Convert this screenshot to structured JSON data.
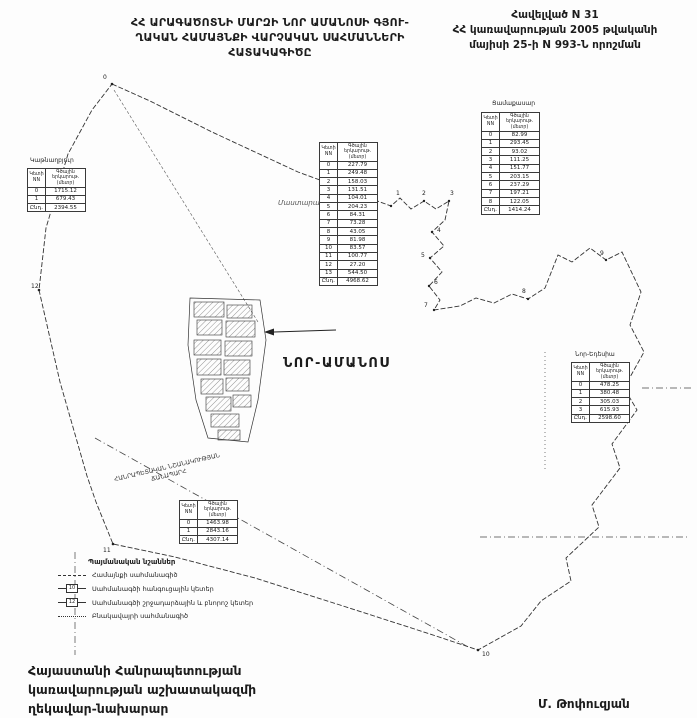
{
  "header": {
    "title_lines": [
      "ՀՀ ԱՐԱԳԱԾՈՏՆԻ ՄԱՐԶԻ ՆՈՐ ԱՄԱՆՈՍԻ ԳՅՈՒ-",
      "ՂԱԿԱՆ ՀԱՄԱՅՆՔԻ ՎԱՐՉԱԿԱՆ ՍԱՀՄԱՆՆԵՐԻ",
      "ՀԱՏԱԿԱԳԻԾԸ"
    ],
    "annex_lines": [
      "Հավելված N 31",
      "ՀՀ կառավարության 2005 թվականի",
      "մայիսի 25-ի N 993-Ն որոշման"
    ]
  },
  "map": {
    "center_label": "ՆՈՐ-ԱՄԱՆՈՍ",
    "neighbor_label": "Մաստարա",
    "road_label_lines": [
      "ՀԱՆՐԱՊԵՏԱԿԱՆ ՆՇԱՆԱԿՈՒԹՅԱՆ",
      "ՃԱՆԱՊԱՐՀ"
    ],
    "point_labels": [
      "0",
      "1",
      "2",
      "3",
      "4",
      "5",
      "6",
      "7",
      "8",
      "9",
      "10",
      "11",
      "12"
    ]
  },
  "tables": {
    "left": {
      "title": "Կաթնաղբյուր",
      "header": [
        "Կետի NN",
        "Գծային երկարութ. (մետր)"
      ],
      "rows": [
        [
          "0",
          "1715.12"
        ],
        [
          "1",
          "679.43"
        ],
        [
          "Ընդ.",
          "2394.55"
        ]
      ]
    },
    "center": {
      "title": "",
      "header": [
        "Կետի NN",
        "Գծային երկարութ. (մետր)"
      ],
      "rows": [
        [
          "0",
          "227.79"
        ],
        [
          "1",
          "249.48"
        ],
        [
          "2",
          "158.03"
        ],
        [
          "3",
          "131.51"
        ],
        [
          "4",
          "104.01"
        ],
        [
          "5",
          "204.23"
        ],
        [
          "6",
          "84.31"
        ],
        [
          "7",
          "73.28"
        ],
        [
          "8",
          "43.05"
        ],
        [
          "9",
          "81.98"
        ],
        [
          "10",
          "83.57"
        ],
        [
          "11",
          "100.77"
        ],
        [
          "12",
          "27.20"
        ],
        [
          "13",
          "544.50"
        ],
        [
          "Ընդ.",
          "4968.62"
        ]
      ]
    },
    "topright": {
      "title": "Ցամաքասար",
      "header": [
        "Կետի NN",
        "Գծային երկարութ. (մետր)"
      ],
      "rows": [
        [
          "0",
          "82.99"
        ],
        [
          "1",
          "293.45"
        ],
        [
          "2",
          "93.02"
        ],
        [
          "3",
          "111.25"
        ],
        [
          "4",
          "151.77"
        ],
        [
          "5",
          "203.15"
        ],
        [
          "6",
          "237.29"
        ],
        [
          "7",
          "197.21"
        ],
        [
          "8",
          "122.05"
        ],
        [
          "Ընդ.",
          "1414.24"
        ]
      ]
    },
    "right": {
      "title": "Նոր-Եդեսիա",
      "header": [
        "Կետի NN",
        "Գծային երկարութ. (մետր)"
      ],
      "rows": [
        [
          "0",
          "478.25"
        ],
        [
          "1",
          "380.48"
        ],
        [
          "2",
          "305.03"
        ],
        [
          "3",
          "615.93"
        ],
        [
          "Ընդ.",
          "2598.60"
        ]
      ]
    },
    "bottom": {
      "title": "",
      "header": [
        "Կետի NN",
        "Գծային երկարութ. (մետր)"
      ],
      "rows": [
        [
          "0",
          "1463.98"
        ],
        [
          "1",
          "2843.16"
        ],
        [
          "Ընդ.",
          "4307.14"
        ]
      ]
    }
  },
  "legend": {
    "title": "Պայմանական նշաններ",
    "items": [
      {
        "symbol": "community-boundary-line",
        "symbol_text": "",
        "label": "Համայնքի սահմանագիծ"
      },
      {
        "symbol": "node-point-box",
        "symbol_text": "10",
        "label": "Սահմանագծի հանգուցային կետեր"
      },
      {
        "symbol": "turn-point-box",
        "symbol_text": "12",
        "label": "Սահմանագծի շրջադարձային և բնորոշ կետեր"
      },
      {
        "symbol": "settlement-boundary-line",
        "symbol_text": "",
        "label": "Բնակավայրի սահմանագիծ"
      }
    ]
  },
  "footer": {
    "signature_lines": [
      "Հայաստանի Հանրապետության",
      "կառավարության աշխատակազմի",
      "ղեկավար-նախարար"
    ],
    "signer": "Մ. Թոփուզյան"
  },
  "colors": {
    "ink": "#1c1c1c",
    "line": "#3a3a3a",
    "paper": "#fdfdfd"
  }
}
